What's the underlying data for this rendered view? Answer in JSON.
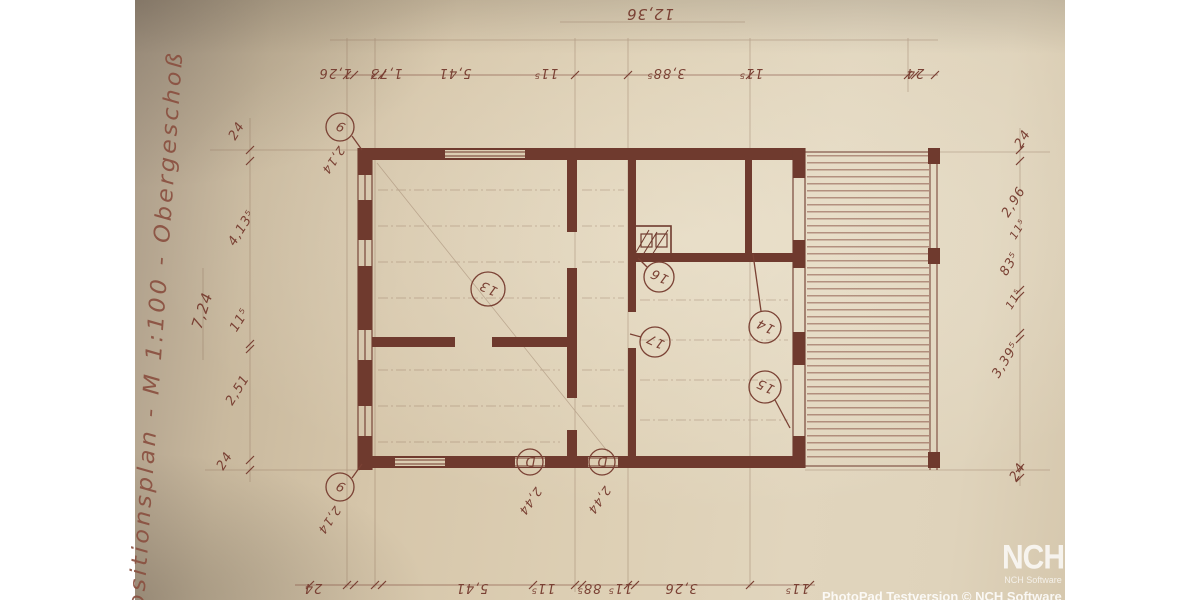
{
  "side_title": "ositionsplan - M 1:100 - Obergeschoß",
  "plan": {
    "total_top": "12,36",
    "total_left": "7,24",
    "top_chain": [
      "1,26",
      "1,73",
      "5,41",
      "11⁵",
      "3,88⁵",
      "11⁵",
      "24"
    ],
    "bottom_chain": [
      "24",
      "5,41",
      "11⁵",
      "88⁵",
      "11⁵",
      "3,26",
      "11⁵"
    ],
    "left_chain": [
      "24",
      "4,13⁵",
      "11⁵",
      "2,51",
      "24"
    ],
    "right_chain": [
      "24",
      "2,96",
      "11⁵",
      "83⁵",
      "11⁵",
      "3,39⁵",
      "24"
    ],
    "markers": {
      "m1": "9",
      "m2": "9",
      "m3": "13",
      "m4": "16",
      "m5": "17",
      "m6": "14",
      "m7": "15",
      "d1": "D",
      "d2": "D"
    },
    "annotations": {
      "ax1": "2,14",
      "ax2": "2,14",
      "door1": "2,44",
      "door2": "2,44"
    }
  },
  "watermark": {
    "logo_text": "NCH",
    "logo_subtext": "NCH Software",
    "banner_text": "PhotoPad Testversion © NCH Software"
  },
  "colors": {
    "ink": "#7a4134",
    "paper": "#d9c9ad"
  }
}
